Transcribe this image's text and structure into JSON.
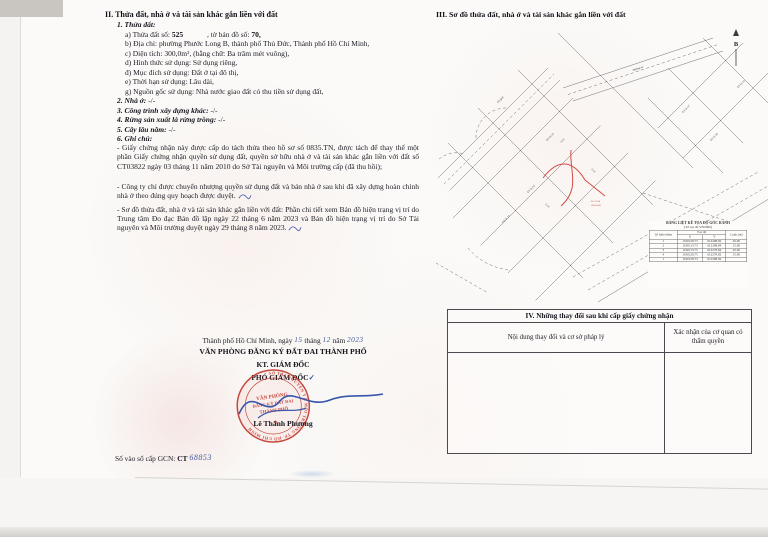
{
  "document": {
    "section2": {
      "title": "II. Thửa đất, nhà ở và tài sản khác gắn liền với đất",
      "plot": {
        "label": "1. Thửa đất:",
        "a_label": "a) Thửa đất số:",
        "a_value": "525",
        "a_label2": ", tờ bản đồ số:",
        "a_value2": "70,",
        "b": "b) Địa chỉ: phường Phước Long B, thành phố Thủ Đức, Thành phố Hồ Chí Minh,",
        "c": "c) Diện tích: 300,0m², (bằng chữ: Ba trăm mét vuông),",
        "d": "d) Hình thức sử dụng: Sử dụng riêng,",
        "dd": "đ) Mục đích sử dụng: Đất ở tại đô thị,",
        "e": "e) Thời hạn sử dụng: Lâu dài,",
        "g": "g) Nguồn gốc sử dụng: Nhà nước giao đất có thu tiền sử dụng đất,"
      },
      "items": [
        {
          "label": "2. Nhà ở:",
          "value": "-/-"
        },
        {
          "label": "3. Công trình xây dựng khác:",
          "value": "-/-"
        },
        {
          "label": "4. Rừng sản xuất là rừng trồng:",
          "value": "-/-"
        },
        {
          "label": "5. Cây lâu năm:",
          "value": "-/-"
        },
        {
          "label": "6. Ghi chú:",
          "value": ""
        }
      ],
      "notes": [
        "- Giấy chứng nhận này được cấp do tách thửa theo hồ sơ số 0835.TN, được tách để thay thế một phần Giấy chứng nhận quyền sử dụng đất, quyền sở hữu nhà ở và tài sản khác gắn liền với đất số CT03822 ngày 03 tháng 11 năm 2010 do Sở Tài nguyên và Môi trường cấp (đã thu hồi);",
        "- Công ty chỉ được chuyển nhượng quyền sử dụng đất và bán nhà ở sau khi đã xây dựng hoàn chỉnh nhà ở theo đúng quy hoạch được duyệt.",
        "- Sơ đồ thửa đất, nhà ở và tài sản khác gắn liền với đất: Phần chi tiết xem Bản đồ hiện trạng vị trí do Trung tâm Đo đạc Bản đồ lập ngày 22 tháng 6 năm 2023 và Bản đồ hiện trạng vị trí do Sở Tài nguyên và Môi trường duyệt ngày 29 tháng 8 năm 2023."
      ]
    },
    "signing": {
      "place_prefix": "Thành phố Hồ Chí Minh, ngày",
      "day": "15",
      "t1": "tháng",
      "month": "12",
      "t2": "năm",
      "year": "2023",
      "office": "VĂN PHÒNG ĐĂNG KÝ ĐẤT ĐAI THÀNH PHỐ",
      "kt": "KT. GIÁM ĐỐC",
      "deputy": "PHÓ GIÁM ĐỐC",
      "check": "✓",
      "signer": "Lê Thành Phương",
      "stamp": {
        "ring": "SỞ TÀI NGUYÊN VÀ MÔI TRƯỜNG TP. HỒ CHÍ MINH",
        "c1": "VĂN PHÒNG",
        "c2": "ĐĂNG KÝ ĐẤT ĐAI",
        "c3": "THÀNH PHỐ",
        "star": "★"
      }
    },
    "footer": {
      "label": "Số vào sổ cấp GCN:",
      "code": "CT",
      "number": "68853"
    },
    "section3": {
      "title": "III. Sơ đồ thửa đất, nhà ở và tài sản khác gắn liền với đất",
      "map": {
        "north_label": "B",
        "labels": [
          {
            "text": "Lô 51.02"
          },
          {
            "text": "Lô 51.03"
          },
          {
            "text": "Lô 51.15"
          },
          {
            "text": "Lô 51.07"
          },
          {
            "text": "Lô 51.08"
          },
          {
            "text": "Lô 51.10"
          },
          {
            "text": "Lộ giới"
          },
          {
            "text": "Đường số"
          },
          {
            "text": "20.00"
          },
          {
            "text": "15.00"
          },
          {
            "text": "15.00"
          }
        ],
        "red_label": {
          "line1": "Lô 51.04",
          "line2": "(300.0m²)"
        }
      },
      "coord_table": {
        "title": "BẢNG LIỆT KÊ TỌA ĐỘ GÓC RANH",
        "subtitle": "(Tờ tọa độ VN2000)",
        "col_point": "Số hiệu điểm",
        "col_coords": "Tọa độ",
        "col_x": "X",
        "col_y": "Y",
        "col_edge": "Cạnh (m)",
        "rows": [
          {
            "n": "1",
            "x": "1190128.73",
            "y": "612298.82",
            "c": "20.00"
          },
          {
            "n": "2",
            "x": "1190113.73",
            "y": "612298.84",
            "c": "15.00"
          },
          {
            "n": "3",
            "x": "1190113.75",
            "y": "612278.84",
            "c": "20.00"
          },
          {
            "n": "4",
            "x": "1190128.75",
            "y": "612278.82",
            "c": "15.00"
          },
          {
            "n": "1",
            "x": "1190128.73",
            "y": "612298.82",
            "c": ""
          }
        ]
      }
    },
    "section4": {
      "title": "IV. Những thay đổi sau khi cấp giấy chứng nhận",
      "col1": "Nội dung thay đổi và cơ sở pháp lý",
      "col2": "Xác nhận của cơ quan có thẩm quyền"
    }
  }
}
